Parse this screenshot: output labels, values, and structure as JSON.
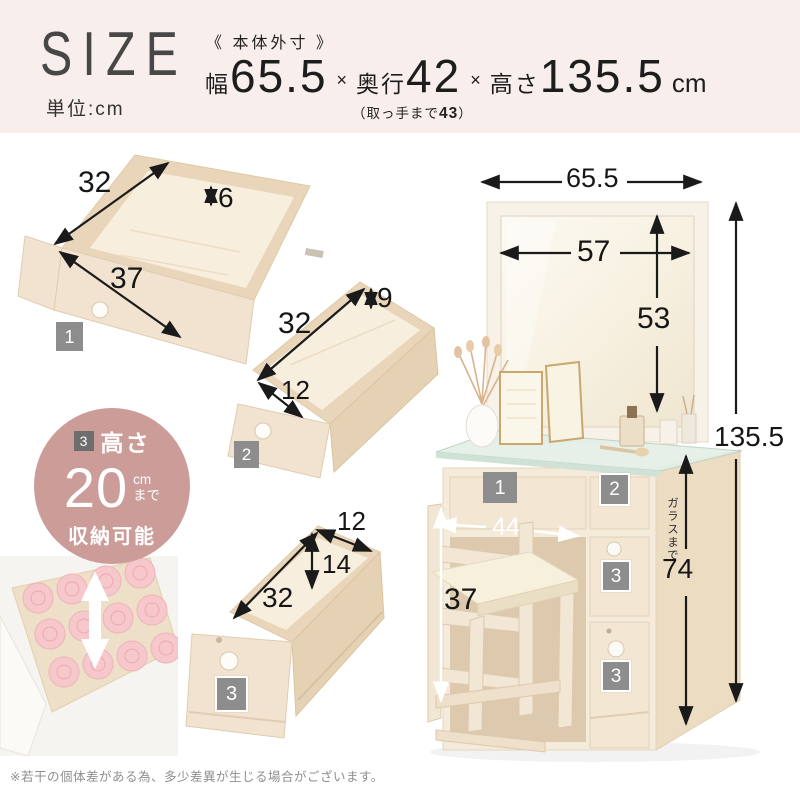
{
  "banner": {
    "title": "SIZE",
    "unit_note": "単位:cm",
    "spec_label": "《 本体外寸 》",
    "width_label": "幅",
    "width_value": "65.5",
    "times1": "×",
    "depth_label": "奥行",
    "depth_value": "42",
    "times2": "×",
    "height_label": "高さ",
    "height_value": "135.5",
    "unit": "cm",
    "handle_note_prefix": "（取っ手まで",
    "handle_note_value": "43",
    "handle_note_suffix": "）"
  },
  "drawer1": {
    "badge": "1",
    "width": "32",
    "rim_height": "6",
    "depth": "37"
  },
  "drawer2": {
    "badge": "2",
    "length": "32",
    "rim_height": "9",
    "width": "12"
  },
  "drawer3": {
    "badge": "3",
    "width": "12",
    "inner_height": "14",
    "length": "32"
  },
  "callout": {
    "badge": "3",
    "label": "高さ",
    "value": "20",
    "unit": "cm",
    "suffix": "まで",
    "caption": "収納可能"
  },
  "vanity": {
    "overall_width": "65.5",
    "mirror_width": "57",
    "mirror_height": "53",
    "overall_height": "135.5",
    "knee_width": "44",
    "stool_height": "37",
    "glass_label": "ガラスまで",
    "glass_height": "74",
    "badge_1": "1",
    "badge_2": "2",
    "badge_3_upper": "3",
    "badge_3_lower": "3"
  },
  "footnote": "※若干の個体差がある為、多少差異が生じる場合がございます。"
}
